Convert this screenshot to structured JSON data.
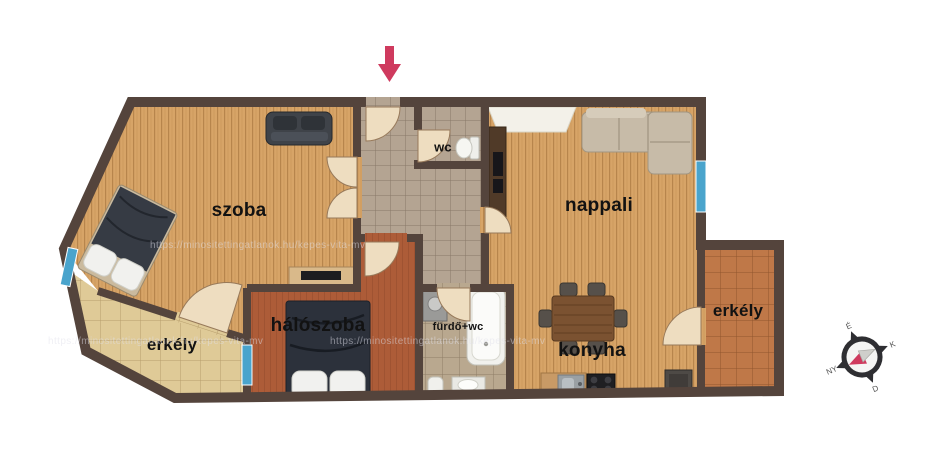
{
  "rooms": {
    "szoba": "szoba",
    "nappali": "nappali",
    "haloszoba": "hálószoba",
    "furdo": "fürdő+wc",
    "konyha": "konyha",
    "wc": "wc",
    "erkely_left": "erkély",
    "erkely_right": "erkély"
  },
  "compass": {
    "n": "É",
    "e": "K",
    "s": "D",
    "w": "NY"
  },
  "watermark": "https://minositettingatlanok.hu/kepes-vita-mv",
  "colors": {
    "wall": "#54443c",
    "wood": "#d7a467",
    "woodLine": "rgba(122,74,26,0.35)",
    "bedroomFloor": "#ad5c38",
    "hallTile": "#b4a492",
    "bathTile": "#b9a88f",
    "erkelyLeftTile": "#dfca97",
    "erkelyRightTile": "#bf7848",
    "window": "#4aa4cc",
    "doorLeaf": "#eeddc0",
    "arrow": "#cf3a5e"
  }
}
